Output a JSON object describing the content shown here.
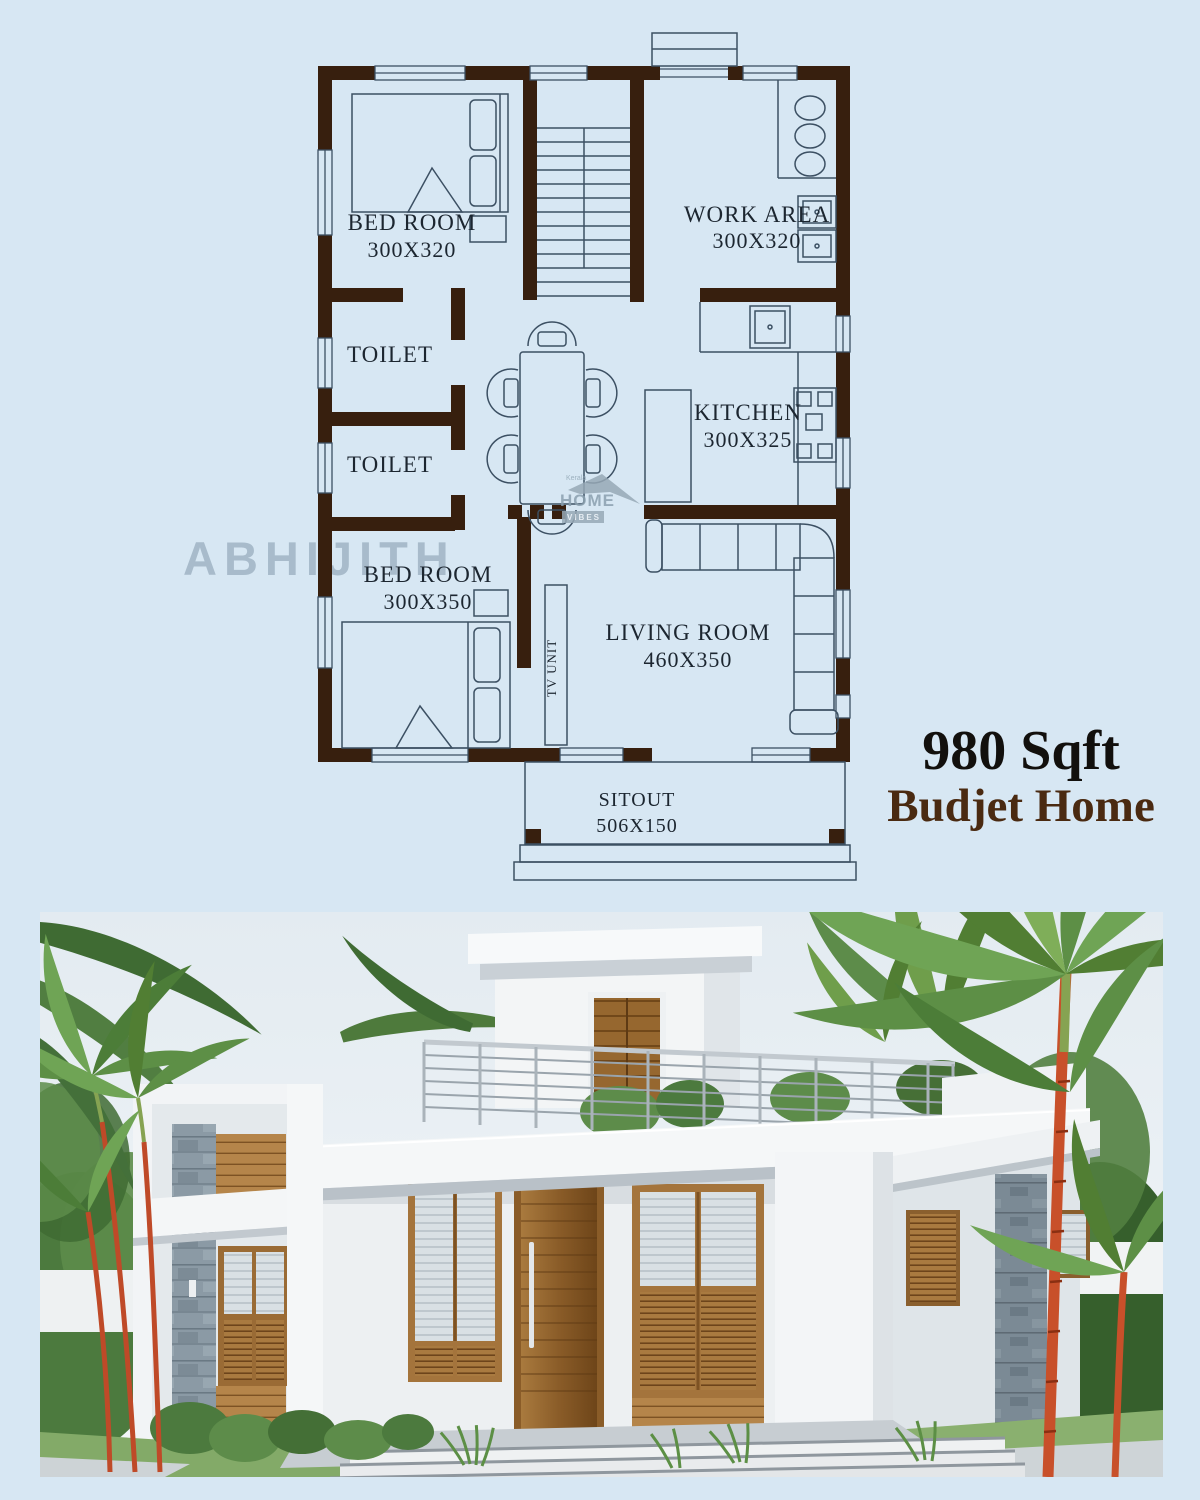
{
  "page": {
    "background": "#d7e7f3"
  },
  "floor_plan": {
    "watermark": "ABHIJITH",
    "logo": {
      "top": "Kerala",
      "name": "HOME",
      "tagline": "VIBES"
    },
    "rooms": {
      "bedroom1": {
        "name": "BED ROOM",
        "size": "300X320"
      },
      "work_area": {
        "name": "WORK AREA",
        "size": "300X320"
      },
      "toilet1": {
        "name": "TOILET"
      },
      "toilet2": {
        "name": "TOILET"
      },
      "kitchen": {
        "name": "KITCHEN",
        "size": "300X325"
      },
      "bedroom2": {
        "name": "BED ROOM",
        "size": "300X350"
      },
      "living_room": {
        "name": "LIVING ROOM",
        "size": "460X350"
      },
      "sitout": {
        "name": "SITOUT",
        "size": "506X150"
      },
      "tv_unit": {
        "name": "TV UNIT"
      }
    },
    "colors": {
      "wall": "#371f0e",
      "line": "#3c5063",
      "text": "#1c2630"
    }
  },
  "caption": {
    "area": "980 Sqft",
    "title": "Budjet Home"
  }
}
